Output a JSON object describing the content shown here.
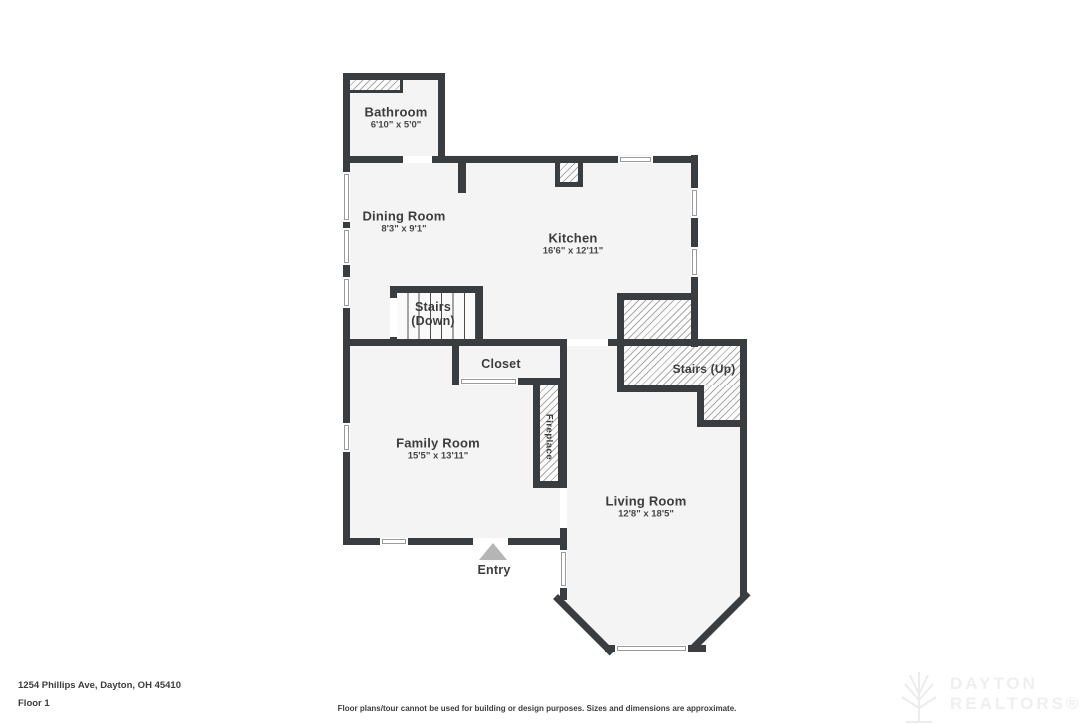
{
  "rooms": {
    "bathroom": {
      "name": "Bathroom",
      "dims": "6'10\" x 5'0\""
    },
    "dining_room": {
      "name": "Dining Room",
      "dims": "8'3\" x 9'1\""
    },
    "kitchen": {
      "name": "Kitchen",
      "dims": "16'6\" x 12'11\""
    },
    "stairs_down": {
      "line1": "Stairs",
      "line2": "(Down)"
    },
    "closet": {
      "name": "Closet"
    },
    "stairs_up": {
      "name": "Stairs (Up)"
    },
    "family_room": {
      "name": "Family Room",
      "dims": "15'5\" x 13'11\""
    },
    "fireplace": {
      "name": "Fireplace"
    },
    "living_room": {
      "name": "Living Room",
      "dims": "12'8\" x 18'5\""
    },
    "entry": {
      "name": "Entry"
    }
  },
  "footer": {
    "address": "1254 Phillips Ave, Dayton, OH 45410",
    "floor_label": "Floor 1",
    "disclaimer": "Floor plans/tour cannot be used for building or design purposes. Sizes and dimensions are approximate."
  },
  "watermark": {
    "line1": "DAYTON",
    "line2": "REALTORS®"
  },
  "colors": {
    "wall": "#3a3d40",
    "floor": "#f4f4f4",
    "background": "#ffffff",
    "entry_arrow": "#b5b5b5",
    "label_text": "#3d3d3d"
  }
}
